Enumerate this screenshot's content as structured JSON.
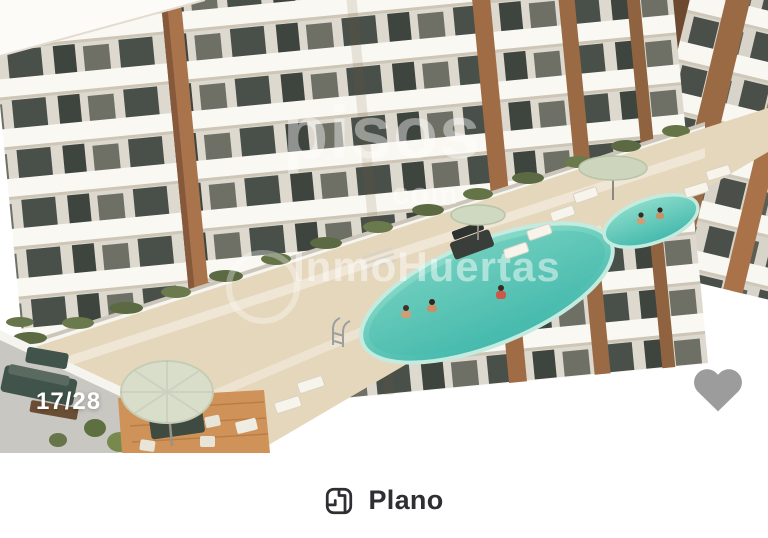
{
  "photo": {
    "counter": "17/28",
    "watermarks": {
      "primary": "pisos",
      "primary_suffix": "com",
      "agency": "InmoHuertas"
    }
  },
  "actions": {
    "plan": {
      "label": "Plano",
      "icon": "floor-plan-icon"
    }
  },
  "icons": {
    "favorite": "heart-icon"
  },
  "colors": {
    "heart": "#9c9c9c",
    "pool_light": "#8adbc9",
    "pool_dark": "#44b9ad",
    "deck": "#e5d7bc",
    "terracotta": "#a9744c",
    "button_text": "#2e2e33",
    "watermark": "rgba(255,255,255,0.45)"
  }
}
